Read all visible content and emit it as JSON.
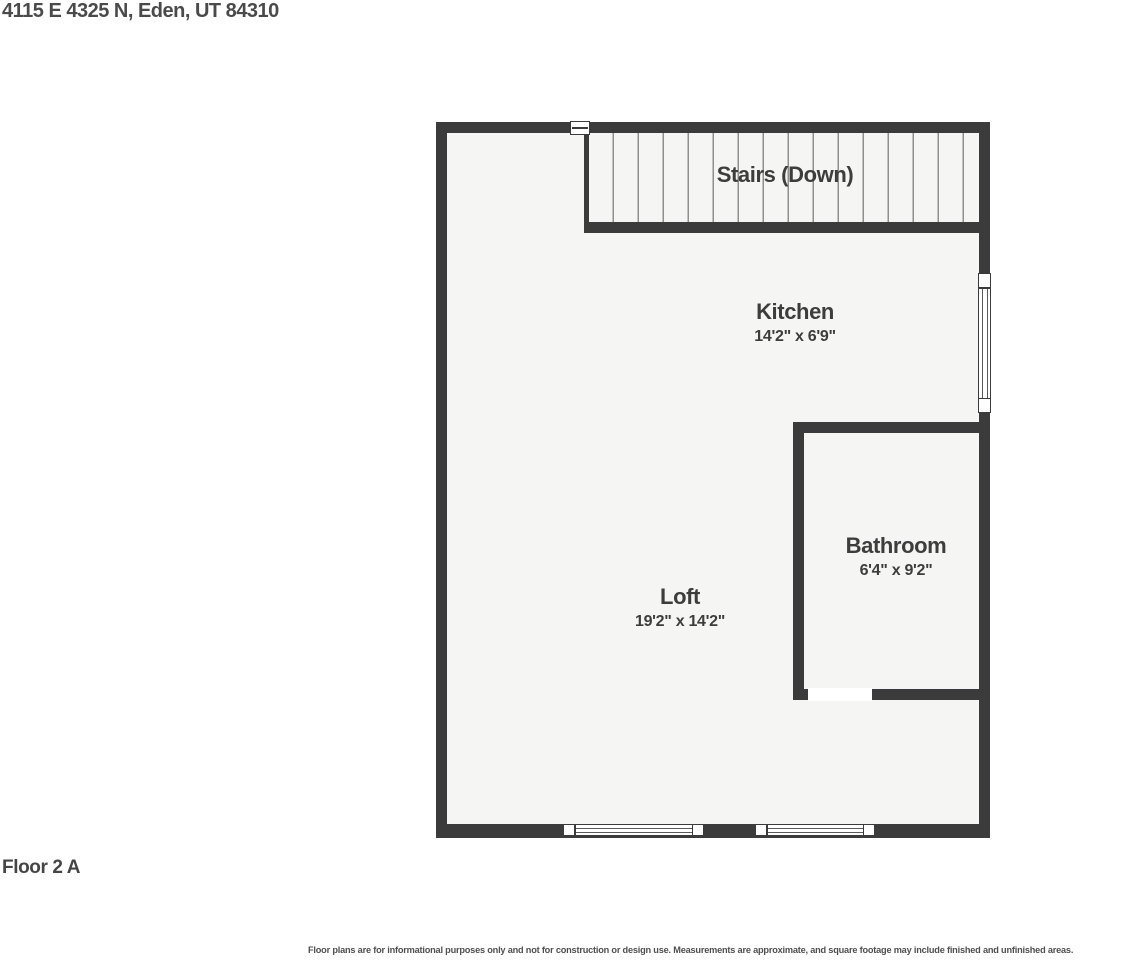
{
  "title": "4115 E 4325 N, Eden, UT 84310",
  "floor_label": "Floor 2 A",
  "disclaimer": "Floor plans are for informational purposes only and not for construction or design use. Measurements are approximate, and square footage may include finished and unfinished areas.",
  "rooms": {
    "stairs": {
      "name": "Stairs (Down)"
    },
    "kitchen": {
      "name": "Kitchen",
      "dimensions": "14'2\" x 6'9\""
    },
    "bathroom": {
      "name": "Bathroom",
      "dimensions": "6'4\" x 9'2\""
    },
    "loft": {
      "name": "Loft",
      "dimensions": "19'2\" x 14'2\""
    }
  },
  "colors": {
    "wall": "#3b3b3b",
    "floor": "#f5f5f4",
    "text": "#3d3d3d",
    "background": "#ffffff"
  }
}
